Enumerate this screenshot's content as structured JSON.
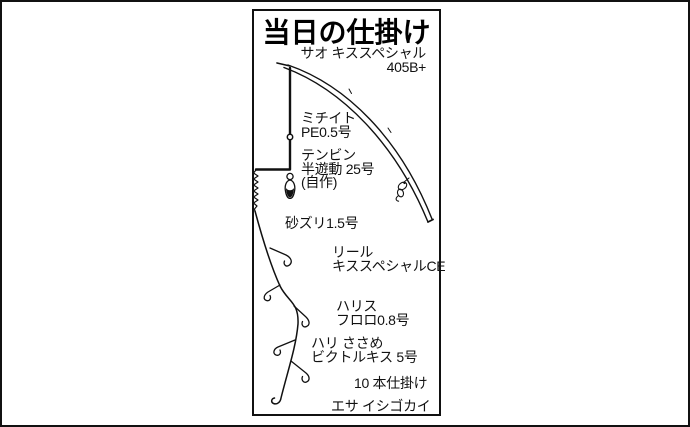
{
  "colors": {
    "ink": "#111111",
    "background": "#ffffff"
  },
  "diagram": {
    "title": "当日の仕掛け",
    "rod": {
      "line1": "サオ キススペシャル",
      "line2": "405B+"
    },
    "main_line": {
      "line1": "ミチイト",
      "line2": "PE0.5号"
    },
    "tenbin": {
      "line1": "テンビン",
      "line2": "半遊動 25号",
      "line3": "(自作)"
    },
    "sand_leader": "砂ズリ1.5号",
    "reel": {
      "line1": "リール",
      "line2": "キススペシャルCE"
    },
    "leader": {
      "line1": "ハリス",
      "line2": "フロロ0.8号"
    },
    "hook": {
      "line1": "ハリ ささめ",
      "line2": "ビクトルキス 5号"
    },
    "rig_count": "10 本仕掛け",
    "bait": "エサ イシゴカイ"
  }
}
